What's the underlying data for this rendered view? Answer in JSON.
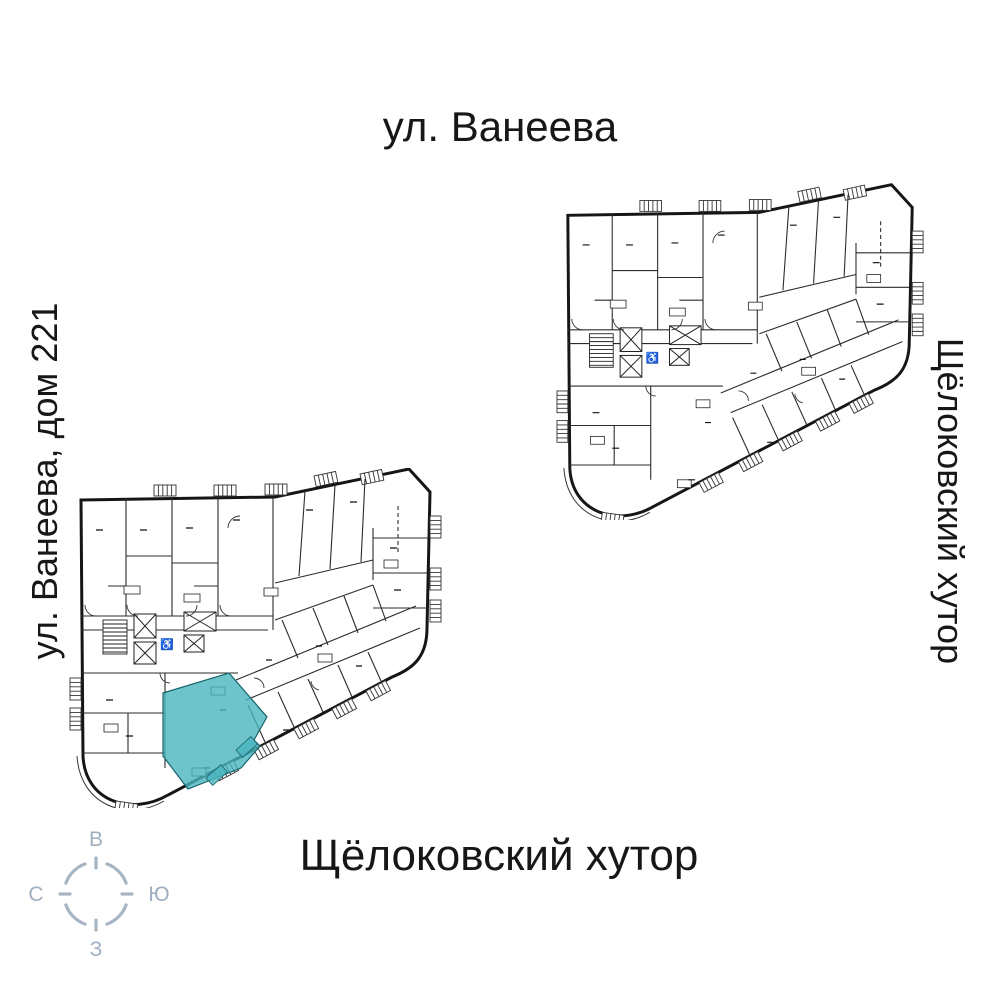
{
  "page": {
    "background": "#ffffff"
  },
  "labels": {
    "street_top": "ул. Ванеева",
    "street_left": "ул. Ванеева, дом 221",
    "street_right": "Щёлоковский хутор",
    "street_bottom": "Щёлоковский хутор"
  },
  "compass": {
    "letters": {
      "top": "В",
      "right": "Ю",
      "bottom": "З",
      "left": "С"
    },
    "ring_color": "#a7b4c2",
    "letter_color": "#9fafc0"
  },
  "plans": {
    "wall_color": "#161616",
    "line_color": "#2b2b2b"
  },
  "highlight": {
    "fill": "#4ab5be",
    "stroke": "#19646c",
    "opacity": "0.8"
  },
  "icons": {
    "accessible_glyph": "♿"
  }
}
